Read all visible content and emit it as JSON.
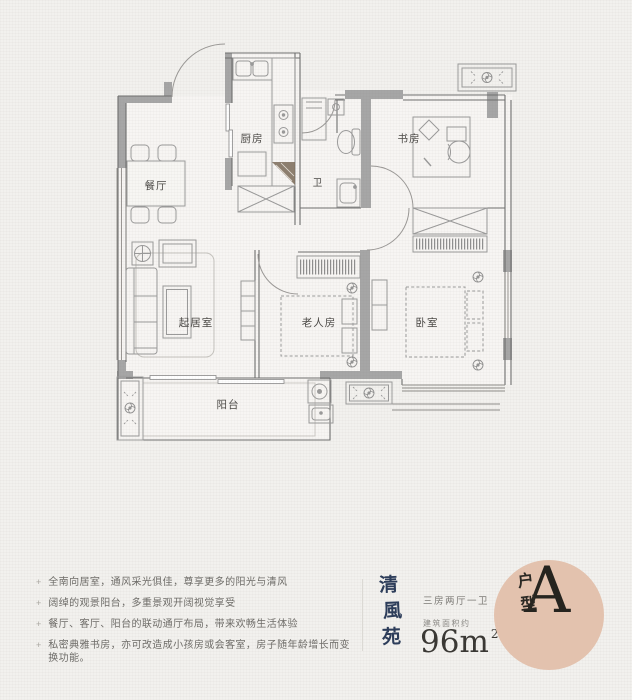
{
  "plan": {
    "rooms": {
      "dining": "餐厅",
      "kitchen": "厨房",
      "bath": "卫",
      "study": "书房",
      "living": "起居室",
      "elder": "老人房",
      "bedroom": "卧室",
      "balcony": "阳台"
    }
  },
  "features": {
    "bullet": "+",
    "items": [
      "全南向居室，通风采光俱佳，尊享更多的阳光与清风",
      "阔绰的观景阳台，多重景观开阔视觉享受",
      "餐厅、客厅、阳台的联动通厅布局，带来欢畅生活体验",
      "私密典雅书房，亦可改造成小孩房或会客室，房子随年龄增长而变换功能。"
    ]
  },
  "brand": {
    "name": "清風苑",
    "chars": [
      "清",
      "風",
      "苑"
    ],
    "color": "#2d3d5a"
  },
  "spec": {
    "layout": "三房两厅一卫",
    "area_label": "建筑面积约",
    "area_value": "96m",
    "area_exponent": "2"
  },
  "badge": {
    "label": "户型",
    "label_chars": [
      "户",
      "型"
    ],
    "value": "A",
    "bg_color": "#e3c2ae"
  },
  "colors": {
    "background": "#f2f1ee",
    "wall_fill": "#a6a6a6",
    "wall_line": "#6f6f6f"
  }
}
